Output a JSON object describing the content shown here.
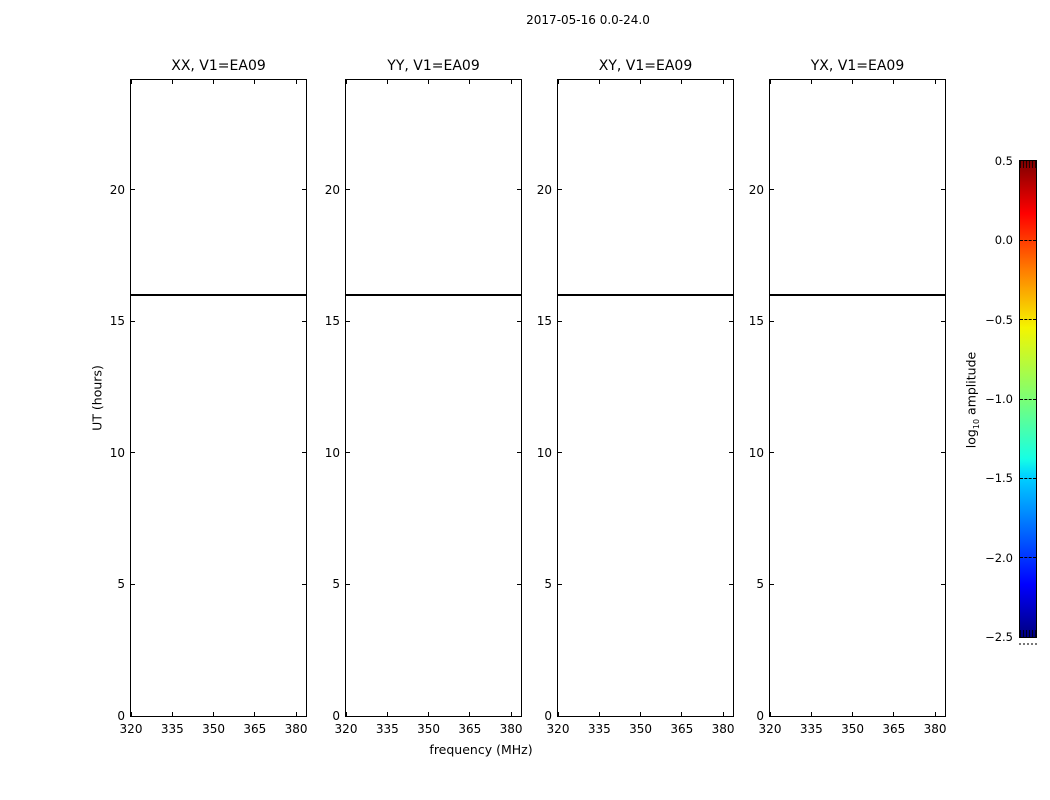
{
  "chart_data": {
    "type": "heatmap",
    "title": "2017-05-16 0.0-24.0",
    "description": "Four blank waterfall panels (UT vs frequency) for polarisation products on baseline V1=EA09; the only plotted data is a single black horizontal row at UT = 16.0 hours spanning all frequencies in every panel",
    "panels": [
      {
        "title": "XX, V1=EA09",
        "data_rows": [
          {
            "ut": 16.0,
            "color": "#000000"
          }
        ]
      },
      {
        "title": "YY, V1=EA09",
        "data_rows": [
          {
            "ut": 16.0,
            "color": "#000000"
          }
        ]
      },
      {
        "title": "XY, V1=EA09",
        "data_rows": [
          {
            "ut": 16.0,
            "color": "#000000"
          }
        ]
      },
      {
        "title": "YX, V1=EA09",
        "data_rows": [
          {
            "ut": 16.0,
            "color": "#000000"
          }
        ]
      }
    ],
    "x": {
      "label": "frequency (MHz)",
      "ticks": [
        320,
        335,
        350,
        365,
        380
      ],
      "tick_labels": [
        "320",
        "335",
        "350",
        "365",
        "380"
      ],
      "range": [
        320,
        383.6
      ]
    },
    "y": {
      "label": "UT (hours)",
      "ticks": [
        0,
        5,
        10,
        15,
        20
      ],
      "tick_labels": [
        "0",
        "5",
        "10",
        "15",
        "20"
      ],
      "range": [
        0,
        24.17
      ]
    },
    "grid": false,
    "legend": false,
    "colorbar": {
      "label_prefix": "log",
      "label_sub": "10",
      "label_suffix": " amplitude",
      "range": [
        -2.5,
        0.5
      ],
      "ticks": [
        0.5,
        0.0,
        -0.5,
        -1.0,
        -1.5,
        -2.0,
        -2.5
      ],
      "tick_labels": [
        "0.5",
        "0.0",
        "−0.5",
        "−1.0",
        "−1.5",
        "−2.0",
        "−2.5"
      ],
      "colormap": "jet",
      "colormap_stops": [
        {
          "pos": 0.0,
          "color": "#7f0000"
        },
        {
          "pos": 0.11,
          "color": "#ff0000"
        },
        {
          "pos": 0.23,
          "color": "#ff7e00"
        },
        {
          "pos": 0.35,
          "color": "#f4f500"
        },
        {
          "pos": 0.5,
          "color": "#7bff75"
        },
        {
          "pos": 0.625,
          "color": "#17ffe4"
        },
        {
          "pos": 0.66,
          "color": "#00d4ff"
        },
        {
          "pos": 0.89,
          "color": "#0000ff"
        },
        {
          "pos": 1.0,
          "color": "#00007f"
        }
      ]
    }
  }
}
